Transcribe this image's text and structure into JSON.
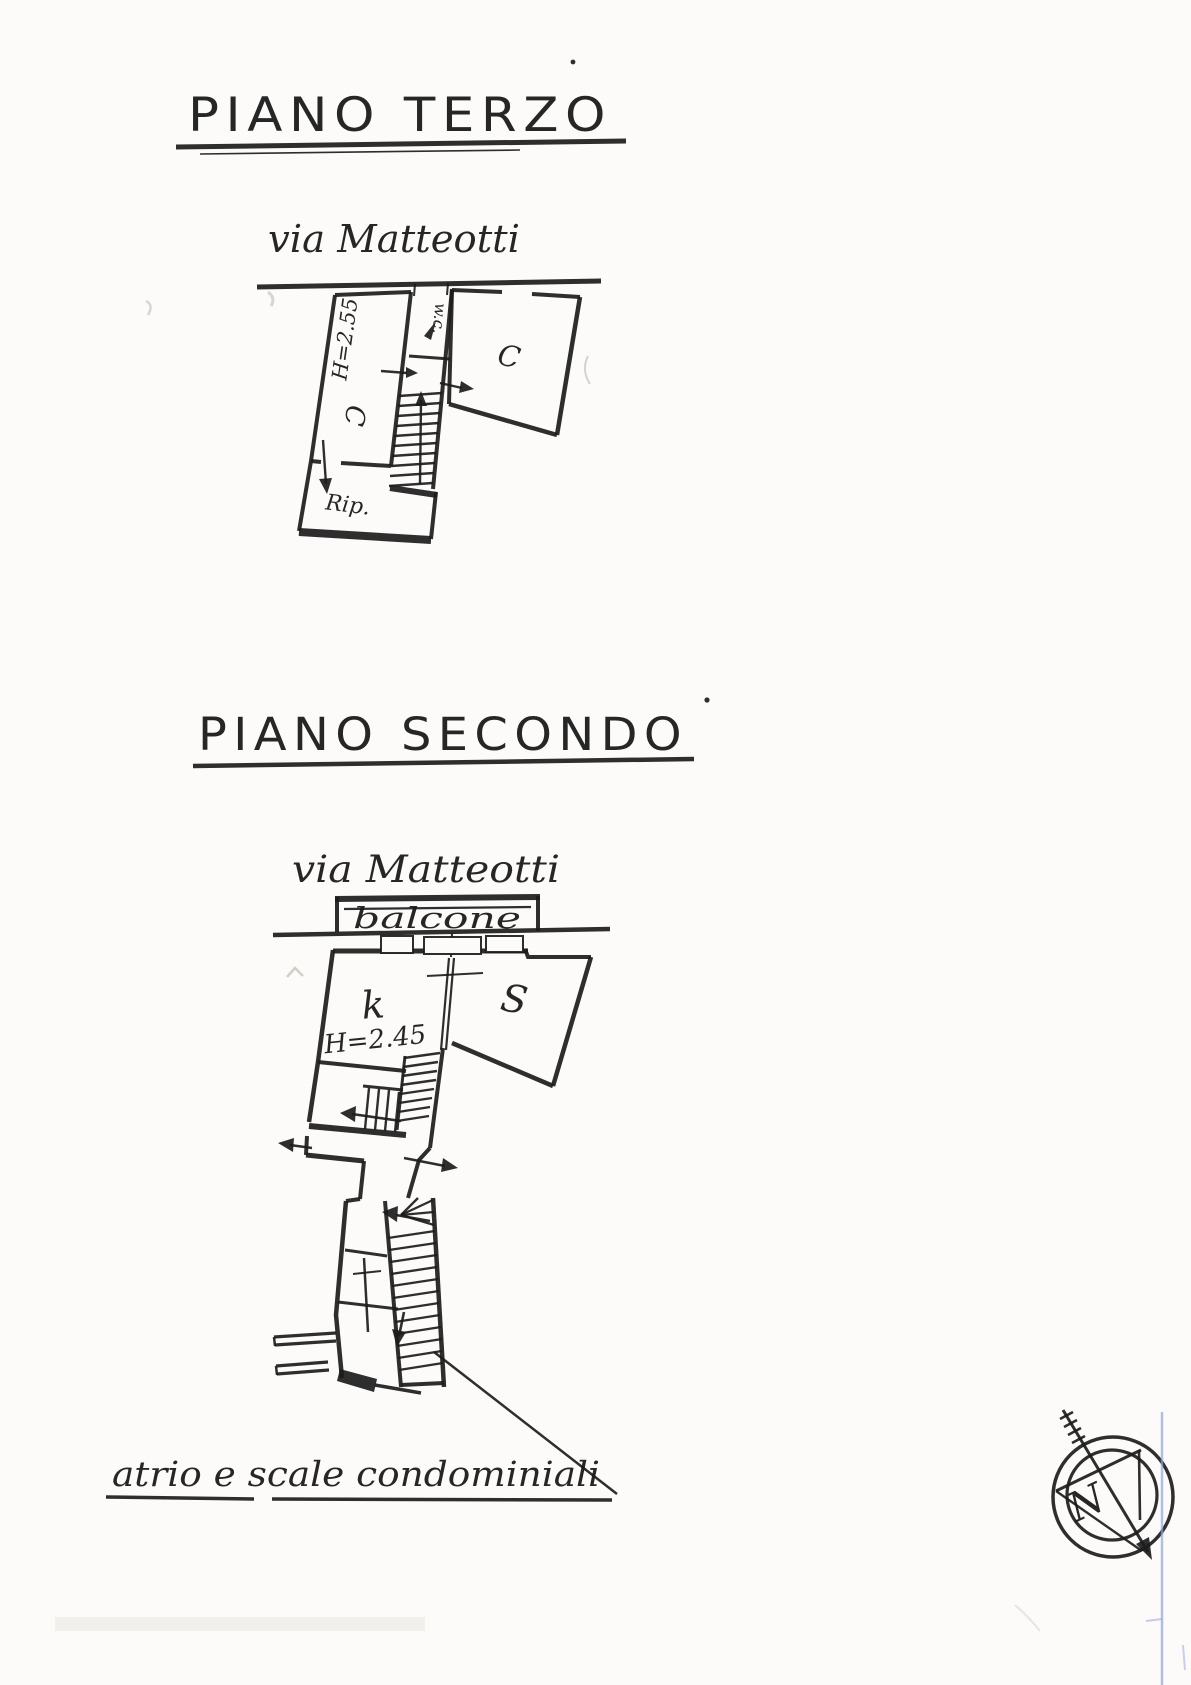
{
  "piano_terzo": {
    "title": "PIANO TERZO",
    "street": "via Matteotti",
    "height_note": "H=2.55",
    "wc_label": "w.c.",
    "room_left": "C",
    "room_right": "C",
    "storage_label": "Rip."
  },
  "piano_secondo": {
    "title": "PIANO SECONDO",
    "street": "via Matteotti",
    "balcony_label": "balcone",
    "kitchen_label": "k",
    "height_note": "H=2.45",
    "living_label": "S",
    "caption": "atrio e scale condominiali"
  },
  "compass": {
    "north": "N"
  },
  "colors": {
    "ink": "#1c1c1c",
    "paper": "#fcfbf9",
    "scan_blue": "#97a3e0"
  }
}
